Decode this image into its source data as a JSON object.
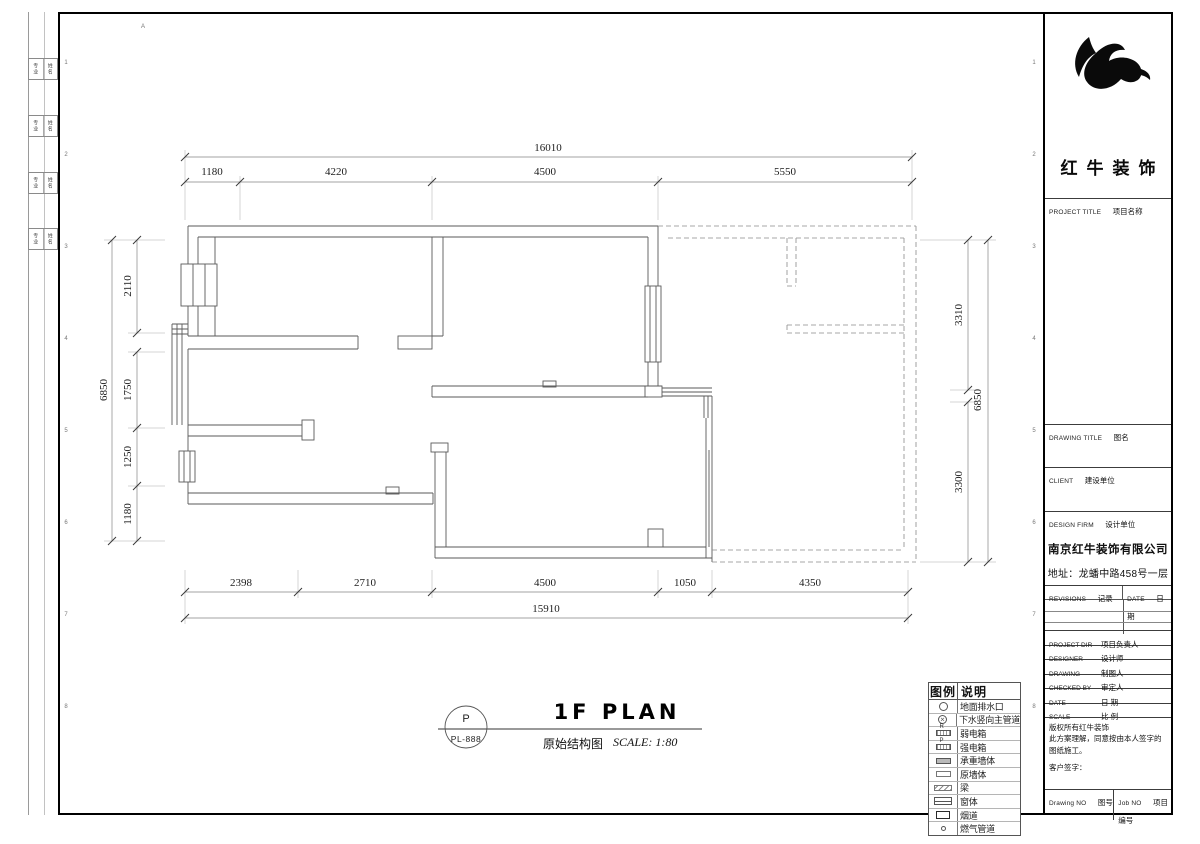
{
  "plan_title": {
    "bubble_top": "P",
    "bubble_bottom": "PL-888",
    "main": "1F PLAN",
    "sub": "原始结构图",
    "scale": "SCALE: 1:80"
  },
  "dimensions": {
    "top_total": "16010",
    "top": [
      "1180",
      "4220",
      "4500",
      "5550"
    ],
    "bottom": [
      "2398",
      "2710",
      "4500",
      "1050",
      "4350"
    ],
    "bottom_total": "15910",
    "left_total": "6850",
    "left": [
      "2110",
      "1750",
      "1250",
      "1180"
    ],
    "right": [
      "3310",
      "3300"
    ],
    "right_total": "6850"
  },
  "legend": {
    "headers": [
      "图例",
      "说明"
    ],
    "items": [
      {
        "symbol": "circle",
        "label": "地面排水口"
      },
      {
        "symbol": "circle-x",
        "label": "下水竖向主管道"
      },
      {
        "symbol": "box-r",
        "letter": "R",
        "label": "弱电箱"
      },
      {
        "symbol": "box-p",
        "letter": "P",
        "label": "强电箱"
      },
      {
        "symbol": "box-solid",
        "label": "承重墙体"
      },
      {
        "symbol": "box-empty",
        "label": "原墙体"
      },
      {
        "symbol": "box-hatch",
        "label": "梁"
      },
      {
        "symbol": "box-lines",
        "label": "窗体"
      },
      {
        "symbol": "box-bold",
        "label": "烟道"
      },
      {
        "symbol": "dot",
        "label": "燃气管道"
      }
    ]
  },
  "title_block": {
    "logo_text": "红牛装饰",
    "project_title_en": "PROJECT TITLE",
    "project_title_cn": "项目名称",
    "drawing_title_en": "DRAWING TITLE",
    "drawing_title_cn": "图名",
    "client_en": "CLIENT",
    "client_cn": "建设单位",
    "design_firm_en": "DESIGN FIRM",
    "design_firm_cn": "设计单位",
    "firm_name": "南京红牛装饰有限公司",
    "firm_address": "地址：龙蟠中路458号一层",
    "revisions_en": "REVISIONS",
    "revisions_cn": "记录",
    "rev_date_en": "DATE",
    "rev_date_cn": "日期",
    "rows": [
      {
        "en": "PROJECT DIR",
        "cn": "项目负责人"
      },
      {
        "en": "DESIGNER",
        "cn": "设计师"
      },
      {
        "en": "DRAWING",
        "cn": "制图人"
      },
      {
        "en": "CHECKED BY",
        "cn": "审定人"
      },
      {
        "en": "DATE",
        "cn": "日  期"
      },
      {
        "en": "SCALE",
        "cn": "比  例"
      }
    ],
    "copyright_line1": "版权所有红牛装饰",
    "copyright_line2": "此方案理解，同意按由本人签字的图纸施工。",
    "signature_label": "客户签字：",
    "drawing_no_en": "Drawing NO",
    "drawing_no_cn": "图号",
    "job_no_en": "Job NO",
    "job_no_cn": "项目编号"
  },
  "sign_strip": {
    "rows": [
      {
        "left": "专业",
        "right": "姓名"
      },
      {
        "left": "专业",
        "right": "姓名"
      },
      {
        "left": "专业",
        "right": "姓名"
      },
      {
        "left": "专业",
        "right": "姓名"
      }
    ]
  },
  "grid_refs": {
    "top_letter": "A",
    "row_numbers": [
      "1",
      "2",
      "3",
      "4",
      "5",
      "6",
      "7",
      "8"
    ]
  }
}
